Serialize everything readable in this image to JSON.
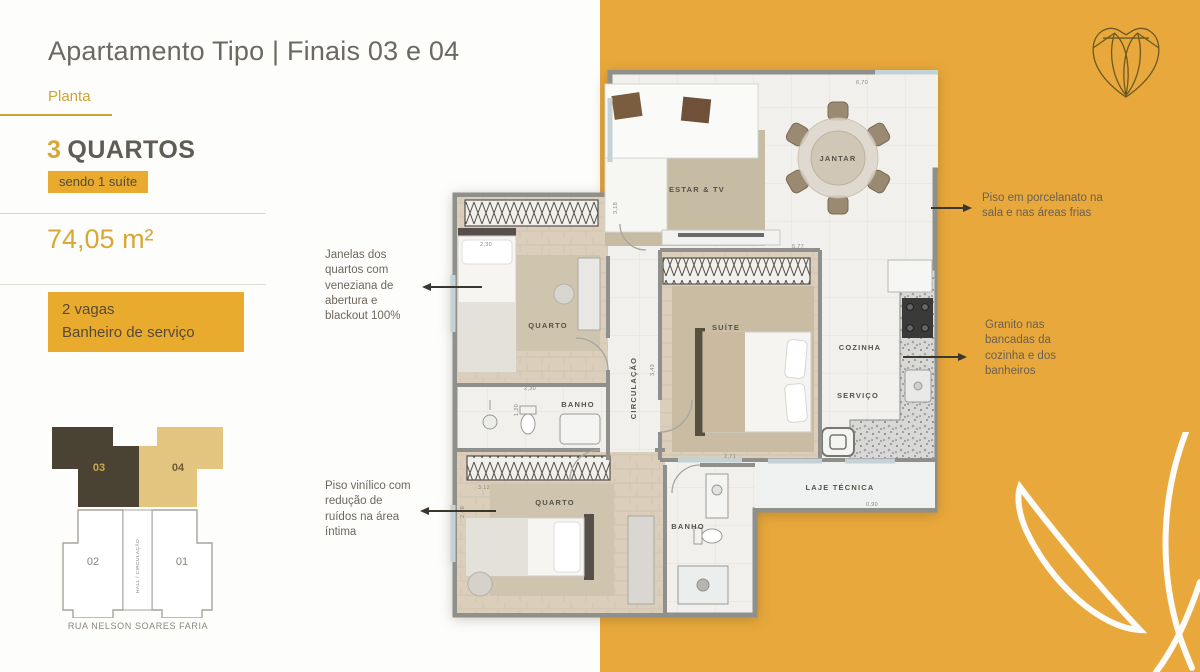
{
  "header": {
    "title": "Apartamento Tipo | Finais 03 e 04",
    "subtitle": "Planta"
  },
  "specs": {
    "bedrooms_count": "3",
    "bedrooms_label": "QUARTOS",
    "suite_badge": "sendo 1 suíte",
    "area": "74,05 m²",
    "features_badge": "2 vagas\nBanheiro de serviço"
  },
  "key_plan": {
    "unit_03": "03",
    "unit_04": "04",
    "unit_02": "02",
    "unit_01": "01",
    "hall_label": "HALL / CIRCULAÇÃO",
    "street_label": "RUA NELSON SOARES FARIA"
  },
  "annotations": {
    "windows": "Janelas dos\nquartos com\nveneziana de\nabertura e\nblackout 100%",
    "vinyl_floor": "Piso vinílico com\nredução de\nruídos na área\níntima",
    "porcelain_floor": "Piso em porcelanato na\nsala e nas áreas frias",
    "granite": "Granito nas\nbancadas da\ncozinha e dos\nbanheiros"
  },
  "floor_plan": {
    "rooms": [
      "ESTAR & TV",
      "JANTAR",
      "QUARTO",
      "SUÍTE",
      "CIRCULAÇÃO",
      "BANHO",
      "COZINHA",
      "SERVIÇO",
      "QUARTO",
      "BANHO",
      "LAJE TÉCNICA"
    ],
    "dimensions": [
      "6,70",
      "1,61",
      "3,18",
      "5,77",
      "2,30",
      "3,43",
      "2,30",
      "1,20",
      "3,12",
      "2,46",
      "2,71",
      "0,90"
    ]
  },
  "colors": {
    "accent_yellow": "#e8a83b",
    "badge_yellow": "#e9ab2e",
    "accent_text": "#cfa436",
    "accent_text2": "#d9a734",
    "title_gray": "#6c6862",
    "unit03_dark": "#4a4233",
    "unit04_tan": "#e3c57f",
    "wall_gray": "#8f8f8c"
  }
}
